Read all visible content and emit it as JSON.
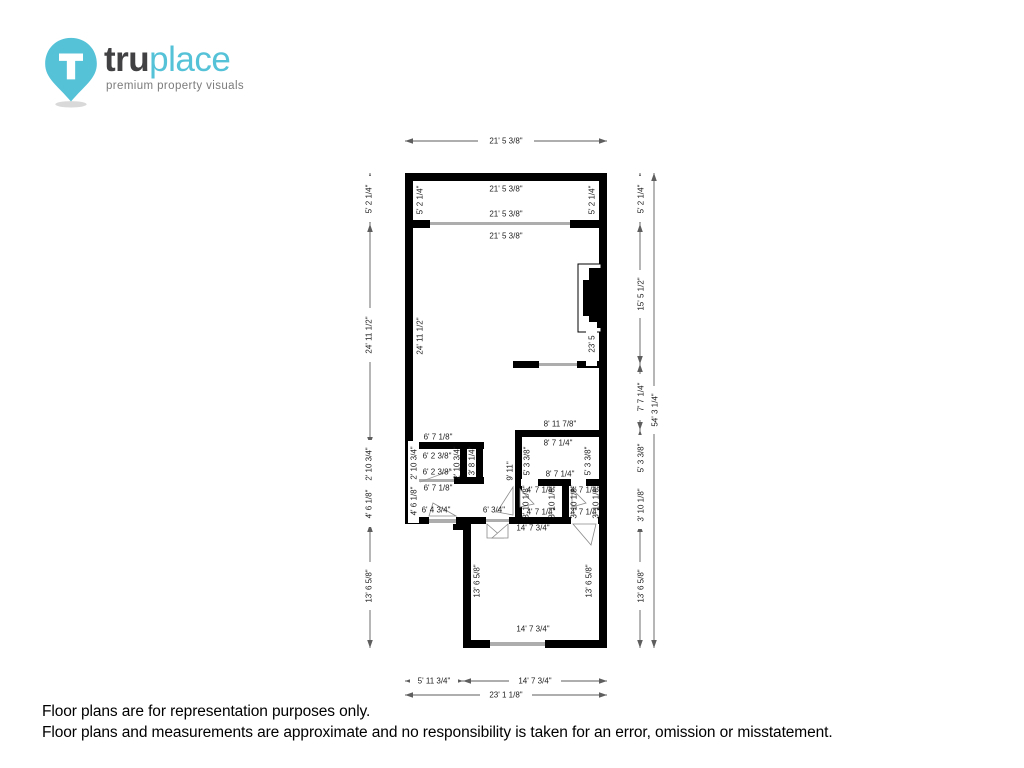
{
  "logo": {
    "brand_bold": "tru",
    "brand_light": "place",
    "tagline": "premium property visuals"
  },
  "colors": {
    "teal": "#55c2d8",
    "wall_black": "#000000",
    "window_gray": "#adadad",
    "dim_line_gray": "#5e5e5e"
  },
  "floor_plan": {
    "dims": {
      "w21": "21' 5 3/8\"",
      "h5_2": "5' 2 1/4\"",
      "h24_11": "24' 11 1/2\"",
      "h23_5": "23' 5",
      "h15_5": "15' 5 1/2\"",
      "h7_7": "7' 7 1/4\"",
      "h54_3": "54' 3 1/4\"",
      "w6_7": "6' 7 1/8\"",
      "w6_2": "6' 2 3/8\"",
      "h2_10": "2' 10 3/4\"",
      "h3_8": "3' 8 1/4\"",
      "h4_6": "4' 6 1/8\"",
      "w6_4": "6' 4 3/4\"",
      "w6_0": "6' 3/4\"",
      "h9_11": "9' 11\"",
      "w8_11": "8' 11 7/8\"",
      "w8_7": "8' 7 1/4\"",
      "h5_3": "5' 3 3/8\"",
      "w4_7": "4' 7 1/4\"",
      "h3_10": "3' 10 1/8\"",
      "w14_7": "14' 7 3/4\"",
      "h13_6": "13' 6 5/8\"",
      "w5_11": "5' 11 3/4\"",
      "w23_1": "23' 1 1/8\""
    }
  },
  "footer": {
    "line1": "Floor plans are for representation purposes only.",
    "line2": "Floor plans and measurements are approximate and no responsibility is taken for an error, omission or misstatement."
  }
}
